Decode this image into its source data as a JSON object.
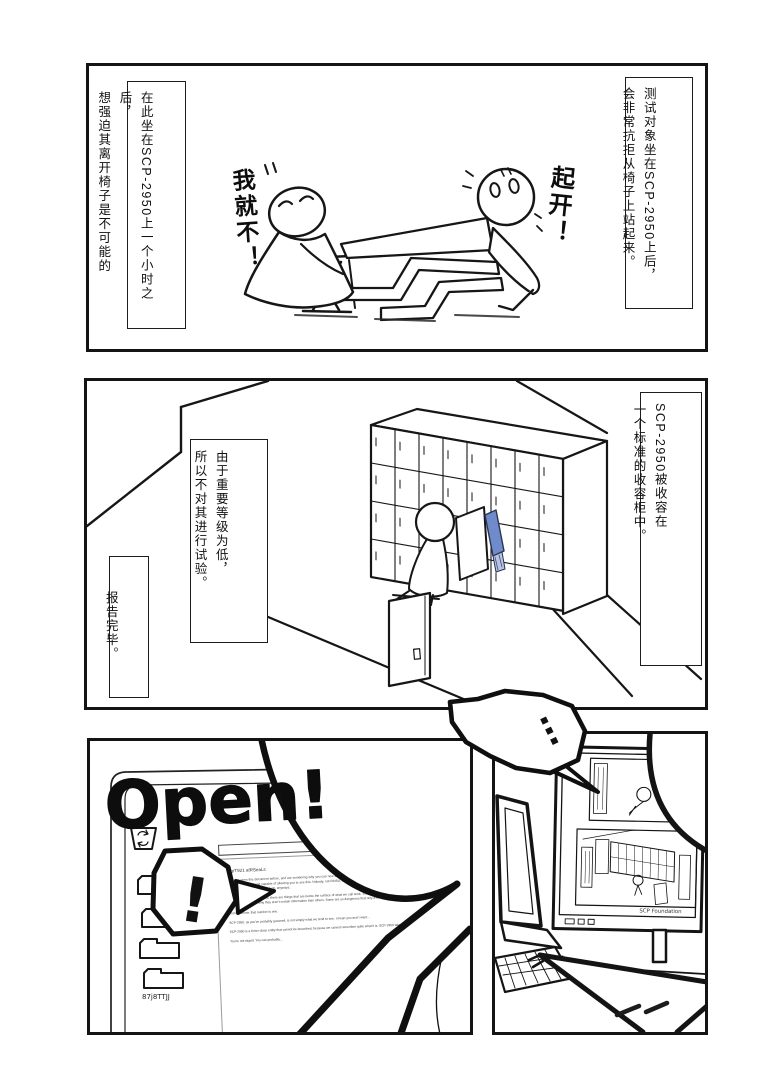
{
  "page": {
    "background": "#ffffff",
    "ink": "#141414"
  },
  "panel1": {
    "caption_right": "测试对象坐在SCP-2950上后，\n会非常抗拒从椅子上站起来。",
    "caption_left": "在此坐在SCP-2950上一个小时之后，\n想强迫其离开椅子是不可能的",
    "speech_refuse": "我就不！",
    "speech_pull": "起开！"
  },
  "panel2": {
    "caption_right": "SCP-2950被收容在\n一个标准的收容柜中。",
    "caption_mid": "由于重要等级为低，\n所以不对其进行试验。",
    "caption_left": "报告完毕。",
    "chair_accent": "#6f8bcb"
  },
  "panel3": {
    "scrawl": "Open!",
    "exclaim": "!",
    "folder_label": "87j8TTJJ",
    "document": {
      "header": "©grT921 afRSeaLs",
      "paragraphs": [
        "If you've seen this document before, and are wondering why you can now see this in addition, it's because you're the only person inoculated with the anti-cognitohazard and capable of allowing you to see this. Nobody, not RAISA, not the researchers, not even the other O5's can see this. They've got their own little projects to work on, anyways.",
        "As you've probably guessed, there are things that are below the surface of what we call work. You've always wondered about the layers hidden inside, and there's a reason why they aren't certain information than others. Some are so dangerous that only a few people ever are.",
        "And somehow, that number is one.",
        "SCP-2950, as you've probably guessed, is not simply what we tend to see. I mean you and I want...",
        "SCP-2950 is a Keter-class entity that cannot be described, because we cannot remember quite what it is. SCP-2950 takes the form...",
        "You're not stupid. You can probably..."
      ]
    }
  },
  "panel4": {
    "ellipsis": "…",
    "screen_caption": "SCP Foundation"
  }
}
